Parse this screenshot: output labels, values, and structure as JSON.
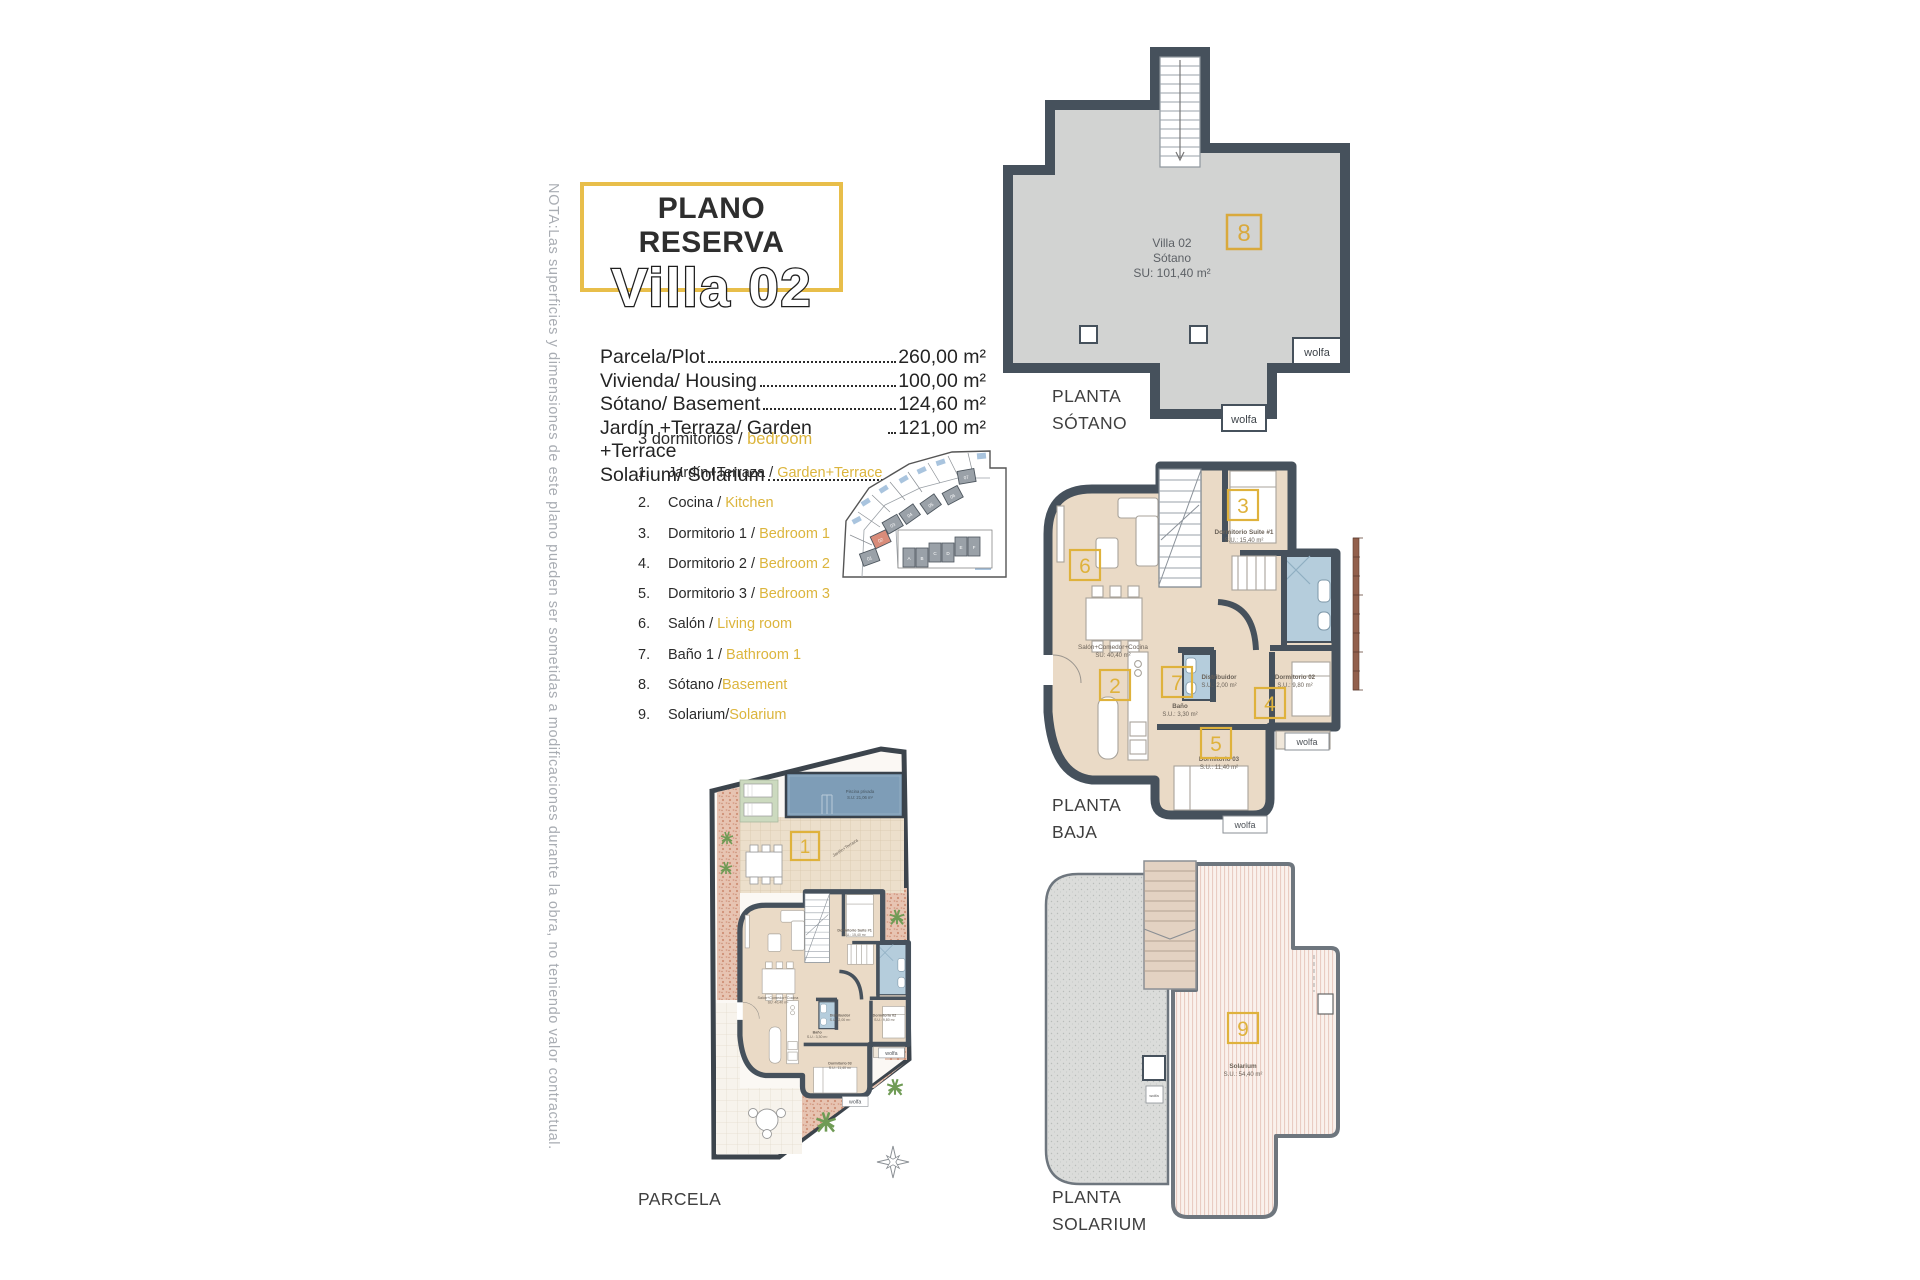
{
  "note": "NOTA:Las superficies y dimensiones de este plano pueden ser sometidas a modificaciones durante la obra, no teniendo valor contractual.",
  "title": {
    "kicker": "PLANO RESERVA",
    "name": "Villa 02"
  },
  "areas": [
    {
      "label": "Parcela/Plot",
      "value": "260,00 m²"
    },
    {
      "label": "Vivienda/ Housing",
      "value": "100,00 m²"
    },
    {
      "label": "Sótano/ Basement",
      "value": "124,60 m²"
    },
    {
      "label": "Jardín +Terraza/ Garden +Terrace",
      "value": "121,00 m²"
    },
    {
      "label": "Solarium/ Solarium",
      "value": "54,40 m²"
    }
  ],
  "legend": {
    "heading_es": "3 dormitorios / ",
    "heading_en": "bedroom",
    "items": [
      {
        "num": "1.",
        "es": "Jardín+Terraza / ",
        "en": "Garden+Terrace"
      },
      {
        "num": "2.",
        "es": "Cocina / ",
        "en": "Kitchen"
      },
      {
        "num": "3.",
        "es": "Dormitorio 1 / ",
        "en": "Bedroom 1"
      },
      {
        "num": "4.",
        "es": "Dormitorio 2 / ",
        "en": "Bedroom 2"
      },
      {
        "num": "5.",
        "es": "Dormitorio 3 / ",
        "en": "Bedroom 3"
      },
      {
        "num": "6.",
        "es": "Salón / ",
        "en": "Living room"
      },
      {
        "num": "7.",
        "es": "Baño 1 / ",
        "en": "Bathroom 1"
      },
      {
        "num": "8.",
        "es": "Sótano /",
        "en": "Basement"
      },
      {
        "num": "9.",
        "es": "Solarium/",
        "en": "Solarium"
      }
    ]
  },
  "sotano": {
    "label1": "PLANTA",
    "label2": "SÓTANO",
    "number": "8",
    "room1": "Villa 02",
    "room2": "Sótano",
    "room3": "SU: 101,40 m²",
    "tag": "wolfa"
  },
  "baja": {
    "label1": "PLANTA",
    "label2": "BAJA",
    "tag": "wolfa",
    "boxes": {
      "living": "6",
      "suite": "3",
      "kitchen": "2",
      "bath": "7",
      "bed2": "4",
      "bed3": "5"
    },
    "rooms": {
      "suite1": "Dormitorio Suite #1",
      "suite2": "S.U.: 15,40 m²",
      "salon1": "Salón+Comedor+Cocina",
      "salon2": "SU: 40,40 m²",
      "dist1": "Distribuidor",
      "dist2": "S.U.: 2,00 m²",
      "bano1": "Baño",
      "bano2": "S.U.: 3,30 m²",
      "dorm2a": "Dormitorio 02",
      "dorm2b": "S.U.: 9,80 m²",
      "dorm3a": "Dormitorio 03",
      "dorm3b": "S.U.: 11,40 m²"
    }
  },
  "parcela": {
    "label": "PARCELA",
    "number": "1",
    "pool1": "Piscina privada",
    "pool2": "S.U: 21,06 m²",
    "garden": "Jardín+Terraza"
  },
  "solarium": {
    "label1": "PLANTA",
    "label2": "SOLARIUM",
    "number": "9",
    "room1": "Solarium",
    "room2": "S.U.: 54,40 m²"
  },
  "sitemap": {
    "plots": [
      "01",
      "02",
      "03",
      "04",
      "05",
      "06",
      "07"
    ],
    "houses": [
      "A",
      "B",
      "C",
      "D",
      "E",
      "F"
    ]
  },
  "colors": {
    "accent_yellow": "#DFB23C",
    "title_border": "#E8BE4A",
    "legend_yellow": "#DCB53D",
    "wall": "#46515C",
    "sotano_gray": "#D2D3D2",
    "floor_beige": "#EADAC6",
    "bath_blue": "#B5CDDC",
    "pool_blue": "#7E9DB7",
    "terracotta": "#E7C4B2",
    "note_gray": "#A9ADB3",
    "highlight_plot": "#D98C7A"
  }
}
